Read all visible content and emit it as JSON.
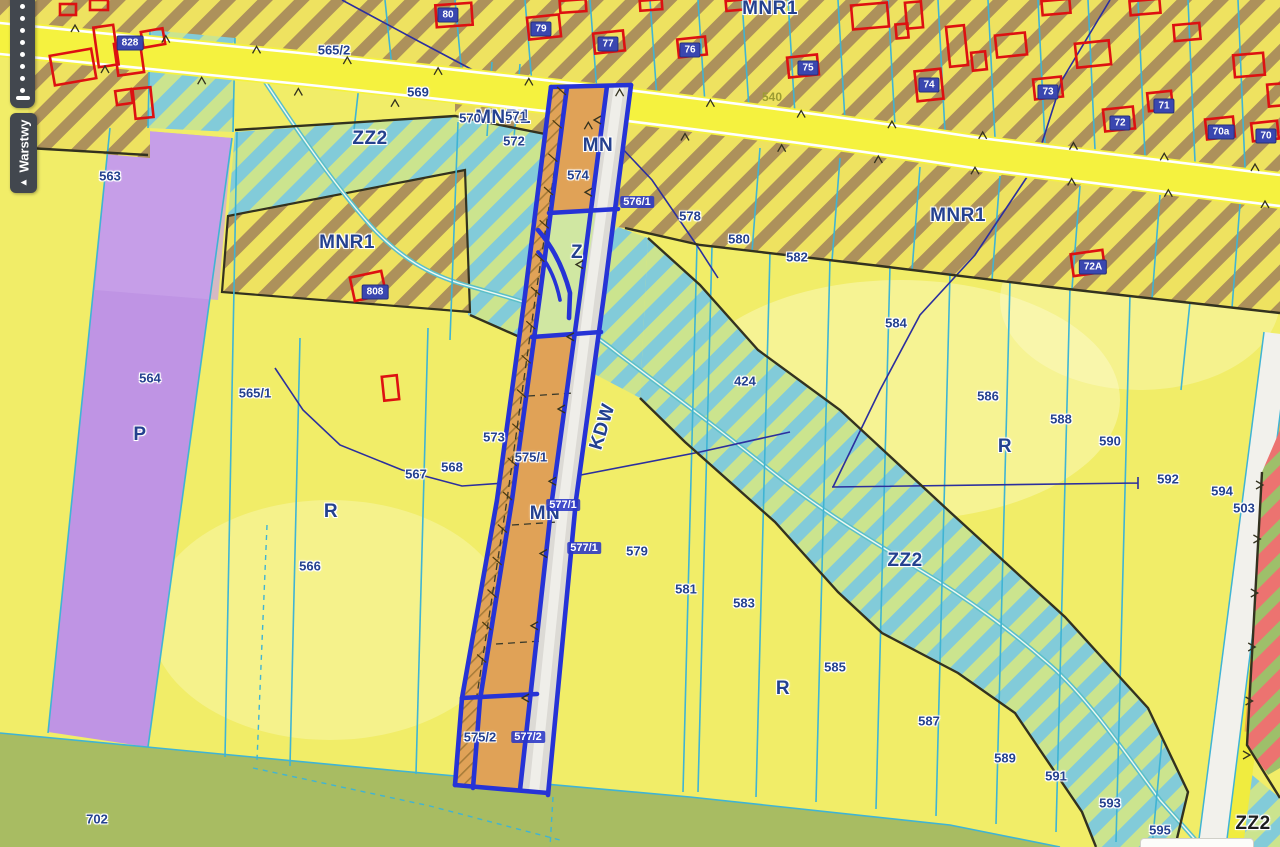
{
  "ui": {
    "layers_tab_label": "Warstwy",
    "toolbar_dot_count": 8
  },
  "map": {
    "colors": {
      "parcel_yellow": "#f1ed68",
      "road_yellow": "#f5f23f",
      "mnr1_hatch_brown": "#a2835a",
      "zz2_cyan": "#82cbd9",
      "zz2_green": "#cbe48e",
      "mn_orange": "#e0a257",
      "z_green": "#d0e7a2",
      "industrial_purple": "#bf94e4",
      "farmland_green": "#a8bc62",
      "flood_red": "#ec7370",
      "selection_blue": "#2633d6",
      "parcel_line_cyan": "#3fb4d4",
      "boundary_navy": "#2c2f9e",
      "building_red": "#dd1111",
      "label_navy": "#24418f"
    },
    "zone_labels": [
      {
        "t": "ZZ2",
        "x": 370,
        "y": 139
      },
      {
        "t": "MNR1",
        "x": 347,
        "y": 243
      },
      {
        "t": "MNR1",
        "x": 503,
        "y": 118
      },
      {
        "t": "MNR1",
        "x": 770,
        "y": 9
      },
      {
        "t": "MNR1",
        "x": 958,
        "y": 216
      },
      {
        "t": "MN",
        "x": 598,
        "y": 146
      },
      {
        "t": "MN",
        "x": 545,
        "y": 514
      },
      {
        "t": "Z",
        "x": 577,
        "y": 253
      },
      {
        "t": "P",
        "x": 140,
        "y": 435
      },
      {
        "t": "R",
        "x": 331,
        "y": 512
      },
      {
        "t": "R",
        "x": 1005,
        "y": 447
      },
      {
        "t": "R",
        "x": 783,
        "y": 689
      },
      {
        "t": "ZZ2",
        "x": 905,
        "y": 561
      },
      {
        "t": "ZZ2",
        "x": 1253,
        "y": 824,
        "cls": "blacktxt"
      },
      {
        "t": "KDW",
        "x": 603,
        "y": 427,
        "rot": -73,
        "cls": "zone"
      }
    ],
    "parcel_labels": [
      {
        "t": "563",
        "x": 110,
        "y": 176
      },
      {
        "t": "564",
        "x": 150,
        "y": 378
      },
      {
        "t": "565/1",
        "x": 255,
        "y": 393
      },
      {
        "t": "565/2",
        "x": 334,
        "y": 50
      },
      {
        "t": "566",
        "x": 310,
        "y": 566
      },
      {
        "t": "567",
        "x": 416,
        "y": 474
      },
      {
        "t": "568",
        "x": 452,
        "y": 467
      },
      {
        "t": "569",
        "x": 418,
        "y": 92
      },
      {
        "t": "570",
        "x": 470,
        "y": 118
      },
      {
        "t": "571",
        "x": 516,
        "y": 116
      },
      {
        "t": "572",
        "x": 514,
        "y": 141
      },
      {
        "t": "573",
        "x": 494,
        "y": 437
      },
      {
        "t": "574",
        "x": 578,
        "y": 175
      },
      {
        "t": "575/1",
        "x": 531,
        "y": 457
      },
      {
        "t": "575/2",
        "x": 480,
        "y": 737
      },
      {
        "t": "578",
        "x": 690,
        "y": 216
      },
      {
        "t": "579",
        "x": 637,
        "y": 551
      },
      {
        "t": "580",
        "x": 739,
        "y": 239
      },
      {
        "t": "581",
        "x": 686,
        "y": 589
      },
      {
        "t": "582",
        "x": 797,
        "y": 257
      },
      {
        "t": "583",
        "x": 744,
        "y": 603
      },
      {
        "t": "584",
        "x": 896,
        "y": 323
      },
      {
        "t": "585",
        "x": 835,
        "y": 667
      },
      {
        "t": "586",
        "x": 988,
        "y": 396
      },
      {
        "t": "587",
        "x": 929,
        "y": 721
      },
      {
        "t": "588",
        "x": 1061,
        "y": 419
      },
      {
        "t": "589",
        "x": 1005,
        "y": 758
      },
      {
        "t": "590",
        "x": 1110,
        "y": 441
      },
      {
        "t": "591",
        "x": 1056,
        "y": 776
      },
      {
        "t": "592",
        "x": 1168,
        "y": 479
      },
      {
        "t": "593",
        "x": 1110,
        "y": 803
      },
      {
        "t": "594",
        "x": 1222,
        "y": 491
      },
      {
        "t": "595",
        "x": 1160,
        "y": 830
      },
      {
        "t": "596",
        "x": 1190,
        "y": 847
      },
      {
        "t": "424",
        "x": 745,
        "y": 381
      },
      {
        "t": "503",
        "x": 1244,
        "y": 508
      },
      {
        "t": "702",
        "x": 97,
        "y": 819
      }
    ],
    "road_labels": [
      {
        "t": "540",
        "x": 772,
        "y": 97
      }
    ],
    "selected_parcel_labels": [
      {
        "t": "576/1",
        "x": 637,
        "y": 202
      },
      {
        "t": "577/1",
        "x": 563,
        "y": 505
      },
      {
        "t": "577/1",
        "x": 584,
        "y": 548
      },
      {
        "t": "577/2",
        "x": 528,
        "y": 737
      }
    ],
    "building_labels": [
      {
        "t": "828",
        "x": 130,
        "y": 43
      },
      {
        "t": "808",
        "x": 375,
        "y": 292
      },
      {
        "t": "80",
        "x": 448,
        "y": 15
      },
      {
        "t": "79",
        "x": 541,
        "y": 29
      },
      {
        "t": "77",
        "x": 608,
        "y": 44
      },
      {
        "t": "76",
        "x": 690,
        "y": 50
      },
      {
        "t": "75",
        "x": 808,
        "y": 68
      },
      {
        "t": "74",
        "x": 929,
        "y": 85
      },
      {
        "t": "73",
        "x": 1048,
        "y": 92
      },
      {
        "t": "72",
        "x": 1120,
        "y": 123
      },
      {
        "t": "71",
        "x": 1164,
        "y": 106
      },
      {
        "t": "70a",
        "x": 1221,
        "y": 132
      },
      {
        "t": "70",
        "x": 1266,
        "y": 136
      },
      {
        "t": "72A",
        "x": 1093,
        "y": 267
      }
    ]
  }
}
